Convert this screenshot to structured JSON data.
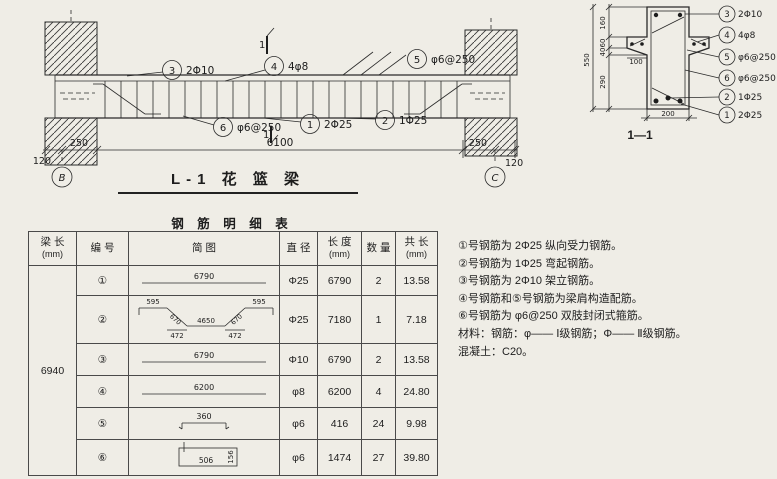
{
  "drawing_title": "L-1 花 篮 梁",
  "elevation": {
    "labels": [
      {
        "num": "3",
        "text": "2Φ10"
      },
      {
        "num": "4",
        "text": "4φ8"
      },
      {
        "num": "5",
        "text": "φ6@250"
      },
      {
        "num": "6",
        "text": "φ6@250"
      },
      {
        "num": "1",
        "text": "2Φ25"
      },
      {
        "num": "2",
        "text": "1Φ25"
      }
    ],
    "section_mark": "1",
    "dims": {
      "span": "6100",
      "bearing_left": "250",
      "offset_left": "120",
      "bearing_right": "250",
      "offset_right": "120"
    },
    "grid_left": "B",
    "grid_right": "C"
  },
  "section": {
    "title": "1—1",
    "labels": [
      {
        "num": "3",
        "text": "2Φ10"
      },
      {
        "num": "4",
        "text": "4φ8"
      },
      {
        "num": "5",
        "text": "φ6@250"
      },
      {
        "num": "6",
        "text": "φ6@250"
      },
      {
        "num": "2",
        "text": "1Φ25"
      },
      {
        "num": "1",
        "text": "2Φ25"
      }
    ],
    "dims": {
      "total_height": "550",
      "seg_top": "160",
      "seg_flange": "60",
      "seg_taper": "40",
      "seg_bottom": "290",
      "flange_width": "100",
      "beam_width": "200"
    }
  },
  "table": {
    "title": "钢 筋 明 细 表",
    "headers": [
      {
        "t": "梁  长",
        "u": "(mm)"
      },
      {
        "t": "编  号",
        "u": ""
      },
      {
        "t": "简        图",
        "u": ""
      },
      {
        "t": "直  径",
        "u": ""
      },
      {
        "t": "长  度",
        "u": "(mm)"
      },
      {
        "t": "数  量",
        "u": ""
      },
      {
        "t": "共  长",
        "u": "(mm)"
      }
    ],
    "beam_length": "6940",
    "rows": [
      {
        "no": "①",
        "diameter": "Φ25",
        "length": "6790",
        "qty": "2",
        "total": "13.58",
        "sketch": {
          "type": "line",
          "label": "6790"
        }
      },
      {
        "no": "②",
        "diameter": "Φ25",
        "length": "7180",
        "qty": "1",
        "total": "7.18",
        "sketch": {
          "type": "bent",
          "top_left": "595",
          "diag_left": "670",
          "bottom": "4650",
          "diag_right": "670",
          "top_right": "595",
          "proj_left": "472",
          "proj_right": "472"
        }
      },
      {
        "no": "③",
        "diameter": "Φ10",
        "length": "6790",
        "qty": "2",
        "total": "13.58",
        "sketch": {
          "type": "line",
          "label": "6790"
        }
      },
      {
        "no": "④",
        "diameter": "φ8",
        "length": "6200",
        "qty": "4",
        "total": "24.80",
        "sketch": {
          "type": "line",
          "label": "6200"
        }
      },
      {
        "no": "⑤",
        "diameter": "φ6",
        "length": "416",
        "qty": "24",
        "total": "9.98",
        "sketch": {
          "type": "hooked",
          "label": "360"
        }
      },
      {
        "no": "⑥",
        "diameter": "φ6",
        "length": "1474",
        "qty": "27",
        "total": "39.80",
        "sketch": {
          "type": "stirrup",
          "width": "506",
          "height": "156"
        }
      }
    ]
  },
  "notes": [
    "①号钢筋为 2Φ25 纵向受力钢筋。",
    "②号钢筋为 1Φ25 弯起钢筋。",
    "③号钢筋为 2Φ10 架立钢筋。",
    "④号钢筋和⑤号钢筋为梁肩构造配筋。",
    "⑥号钢筋为 φ6@250 双肢封闭式箍筋。",
    "材料：钢筋：φ—— Ⅰ级钢筋；Φ—— Ⅱ级钢筋。",
    "混凝土：C20。"
  ]
}
